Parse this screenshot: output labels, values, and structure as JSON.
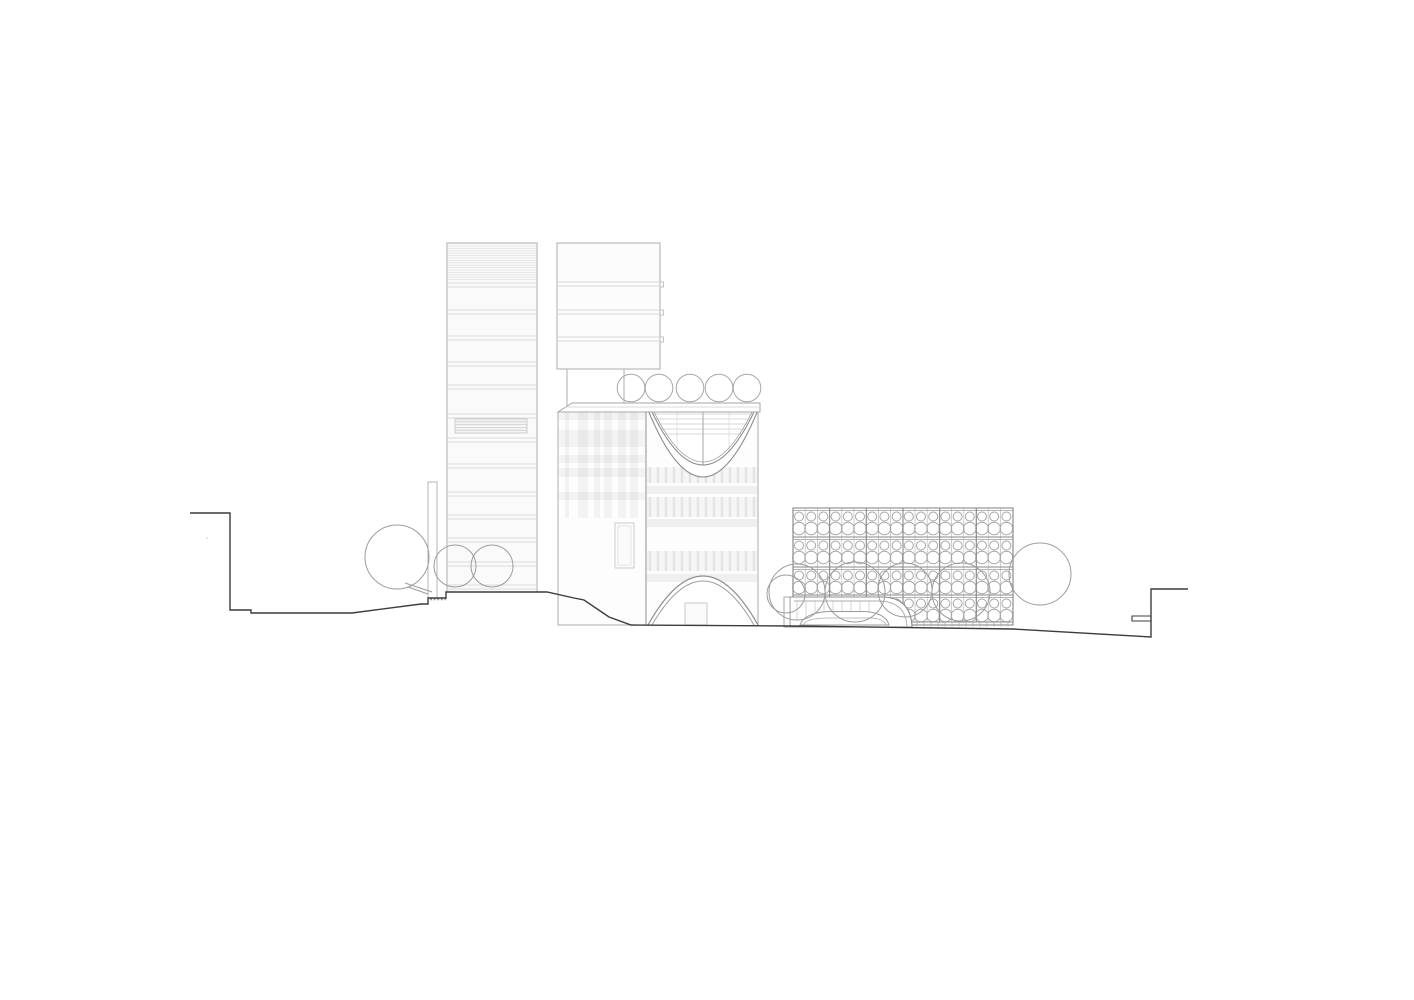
{
  "drawing": {
    "kind": "architectural-elevation-line-drawing",
    "canvas": {
      "width": 1414,
      "height": 1000,
      "background": "#ffffff"
    },
    "colors": {
      "terrain": "#3c3c3c",
      "outline": "#adadad",
      "outline_dark": "#8a8a8a",
      "band": "#d9d9d9",
      "hatch": "#e2e2e2",
      "plaid": "rgba(70,70,70,0.055)",
      "plaid_dark": "rgba(70,70,70,0.075)",
      "tick": "rgba(70,70,70,0.10)",
      "tree": "#9c9c9c",
      "curve": "#8f8f8f",
      "fill_tower": "#fafafa",
      "fill_white": "#fdfdfd",
      "pattern_line": "#a6a6a6",
      "pattern_grid_light": "#bdbdbd"
    },
    "terrain": {
      "profile": [
        [
          190,
          513
        ],
        [
          230,
          513
        ],
        [
          230,
          610
        ],
        [
          251,
          610
        ],
        [
          251,
          613
        ],
        [
          352,
          613
        ],
        [
          421,
          604
        ],
        [
          428,
          604
        ],
        [
          428,
          598
        ],
        [
          446,
          598
        ],
        [
          446,
          592
        ],
        [
          547,
          592
        ],
        [
          574,
          598
        ],
        [
          584,
          600
        ],
        [
          609,
          617
        ],
        [
          631,
          625
        ],
        [
          793,
          626
        ],
        [
          1013,
          629
        ],
        [
          1151,
          637
        ],
        [
          1151,
          589
        ],
        [
          1188,
          589
        ]
      ],
      "notch": [
        1132,
        616,
        1151,
        621
      ],
      "wall_hatch": {
        "x1": 430,
        "x2": 446,
        "y": 599
      },
      "dot": [
        207,
        538
      ]
    },
    "left_tower": {
      "x": 447,
      "w": 90,
      "top": 243,
      "bottom": 592,
      "hatch_y": [
        246,
        281
      ],
      "band_ys": [
        283,
        310,
        336,
        362,
        385,
        414,
        438,
        464,
        492,
        515,
        538,
        562,
        585
      ],
      "louver": [
        455,
        419,
        72,
        14
      ]
    },
    "second_tower": {
      "x": 557,
      "w": 103,
      "top": 243,
      "bottom": 369,
      "band_ys": [
        282,
        310,
        337
      ],
      "shaft": {
        "left_x": 567,
        "right_x": 624,
        "y1": 369,
        "y2": 403
      }
    },
    "retaining_wall": [
      428,
      482,
      9,
      116
    ],
    "roof_trees": {
      "cy": 388,
      "r": 13.8,
      "cx": [
        631,
        659,
        690,
        719,
        747
      ]
    },
    "mid_building": {
      "canopy": {
        "pts": "572,403 760,403 760,412 558,412",
        "inner_y": 407
      },
      "wing": {
        "x": 558,
        "w": 88,
        "top": 412,
        "bottom": 625,
        "strips": [
          [
            565,
            4
          ],
          [
            578,
            10
          ],
          [
            594,
            6
          ],
          [
            604,
            8
          ],
          [
            618,
            8
          ],
          [
            630,
            8
          ]
        ],
        "strip_y2": 518,
        "bands": [
          [
            413,
            7
          ],
          [
            430,
            17
          ],
          [
            455,
            8
          ],
          [
            468,
            9
          ],
          [
            492,
            8
          ]
        ],
        "window": [
          615,
          523,
          19,
          45
        ]
      },
      "block": {
        "x": 646,
        "w": 112,
        "top": 412,
        "bottom": 625,
        "tick_rows": [
          [
            467,
            16
          ],
          [
            497,
            20
          ],
          [
            551,
            20
          ]
        ],
        "bands": [
          [
            486,
            8
          ],
          [
            519,
            8
          ],
          [
            574,
            8
          ]
        ],
        "tick_step": 8
      },
      "bowl": {
        "outer": [
          648,
          410,
          758,
          544
        ],
        "inner": [
          652,
          412,
          754,
          518
        ],
        "inner2": [
          654,
          412,
          752,
          512
        ],
        "glazing_ys": [
          414,
          419,
          424,
          429,
          434
        ],
        "center_x": 703,
        "side_xs": [
          677,
          729
        ]
      },
      "arch": {
        "outer": [
          648,
          625,
          758,
          527
        ],
        "inner": [
          652,
          625,
          754,
          537
        ],
        "door": [
          685,
          603,
          22,
          22
        ]
      }
    },
    "right_building": {
      "x": 793,
      "w": 220,
      "top": 508,
      "base": 625,
      "floors": [
        508,
        537,
        567,
        595
      ],
      "base_line": 622,
      "col_x0": 799,
      "col_step": 12.2,
      "bay_step": 36.67,
      "small": {
        "dy": 8.5,
        "r": 4.5
      },
      "big": {
        "dy": 20.5,
        "r": 6.3
      },
      "plinth": {
        "x1": 908,
        "x2": 1013,
        "y1": 622,
        "y2": 626.5,
        "step": 7
      }
    },
    "podium": {
      "outer": "M790,597 H883 Q911,598 912,627 L790,627 Z",
      "inner": "M794,601 H880 Q906,602 907,627",
      "pier": [
        784,
        597,
        6,
        30
      ],
      "hatch": {
        "x1": 797,
        "x2": 877,
        "step": 9,
        "y1": 601,
        "y2": 620
      },
      "mound_outer": "M800,625 Q804,613 828,611.5 L866,611.5 Q886,613.5 889,625 Z",
      "mound_inner": "M803,625 Q806,618.5 826,618 L872,618 Q884,619 886,625"
    },
    "ground_trees": [
      [
        397,
        557,
        32
      ],
      [
        455,
        566,
        21
      ],
      [
        492,
        566,
        21
      ],
      [
        786,
        594,
        19
      ],
      [
        797,
        592,
        28
      ],
      [
        855,
        592,
        30
      ],
      [
        905,
        590,
        27
      ],
      [
        961,
        592,
        29
      ],
      [
        1040,
        574,
        31
      ]
    ],
    "trunks": [
      [
        405,
        583,
        432,
        592
      ],
      [
        408,
        587,
        428,
        594
      ]
    ]
  }
}
